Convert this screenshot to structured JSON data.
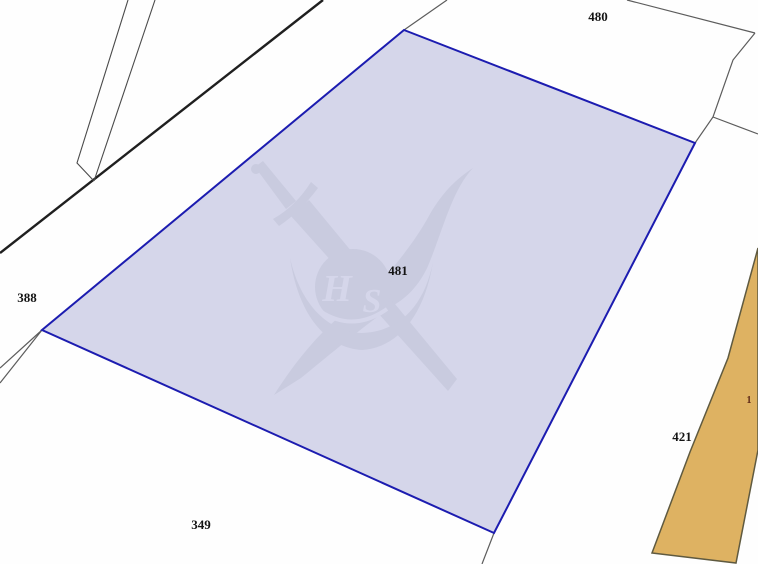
{
  "map": {
    "type": "cadastral-parcel-map",
    "colors": {
      "background": "#fefefe",
      "selected_parcel_fill": "#d5d6ea",
      "selected_parcel_stroke": "#1c1cb0",
      "tan_parcel_fill": "#deb262",
      "tan_parcel_stroke": "#5f5a40",
      "boundary_line": "#4a4a4a",
      "watermark": "#c9cbdf"
    },
    "watermark": {
      "letters": "H",
      "letters2": "S",
      "description": "crossed-swords-emblem"
    },
    "parcels": {
      "selected": {
        "id": "481"
      },
      "tan": {
        "id": "421"
      },
      "top": {
        "id": "480"
      },
      "left": {
        "id": "388"
      },
      "bottom": {
        "id": "349"
      }
    },
    "labels": [
      {
        "text": "480"
      },
      {
        "text": "388"
      },
      {
        "text": "481"
      },
      {
        "text": "349"
      },
      {
        "text": "421"
      },
      {
        "text": "1"
      }
    ]
  }
}
